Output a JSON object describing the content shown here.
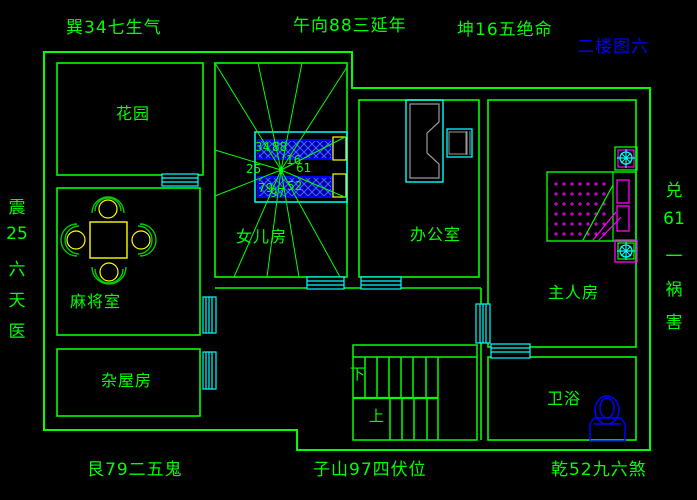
{
  "app": {
    "type": "cad-floor-plan",
    "floor_title": "二楼图六"
  },
  "colors": {
    "background": "#000000",
    "wall_line": "#00ff00",
    "window_line": "#00ffff",
    "blue": "#0000ff",
    "magenta": "#ff00ff",
    "yellow": "#ffff00",
    "desk_gray": "#9a9a9a"
  },
  "edge_labels": {
    "top_left": "巽34七生气",
    "top_center": "午向88三延年",
    "top_right": "坤16五绝命",
    "bottom_left": "艮79二五鬼",
    "bottom_center": "子山97四伏位",
    "bottom_right": "乾52九六煞",
    "left_vertical": [
      "震",
      "25",
      "六",
      "天",
      "医"
    ],
    "right_vertical": [
      "兑",
      "61",
      "一",
      "祸",
      "害"
    ]
  },
  "rooms": {
    "garden": "花园",
    "mahjong": "麻将室",
    "storage": "杂屋房",
    "daughter": "女儿房",
    "office": "办公室",
    "master": "主人房",
    "bath": "卫浴"
  },
  "stairs": {
    "down": "下",
    "up": "上"
  },
  "compass": {
    "se": "34",
    "s": "88",
    "sw": "16",
    "e": "25",
    "w": "61",
    "ne": "79",
    "n": "97",
    "nw": "52"
  },
  "furniture_icons": {
    "mahjong_set": "mahjong-table-with-4-chairs-icon",
    "daughter_beds": "two-hatched-single-beds-icon",
    "office_desk": "desk-with-chair-icon",
    "master_bed": "double-bed-icon",
    "toilet": "toilet-icon",
    "lights": "ceiling-light-crosshair-icon"
  }
}
